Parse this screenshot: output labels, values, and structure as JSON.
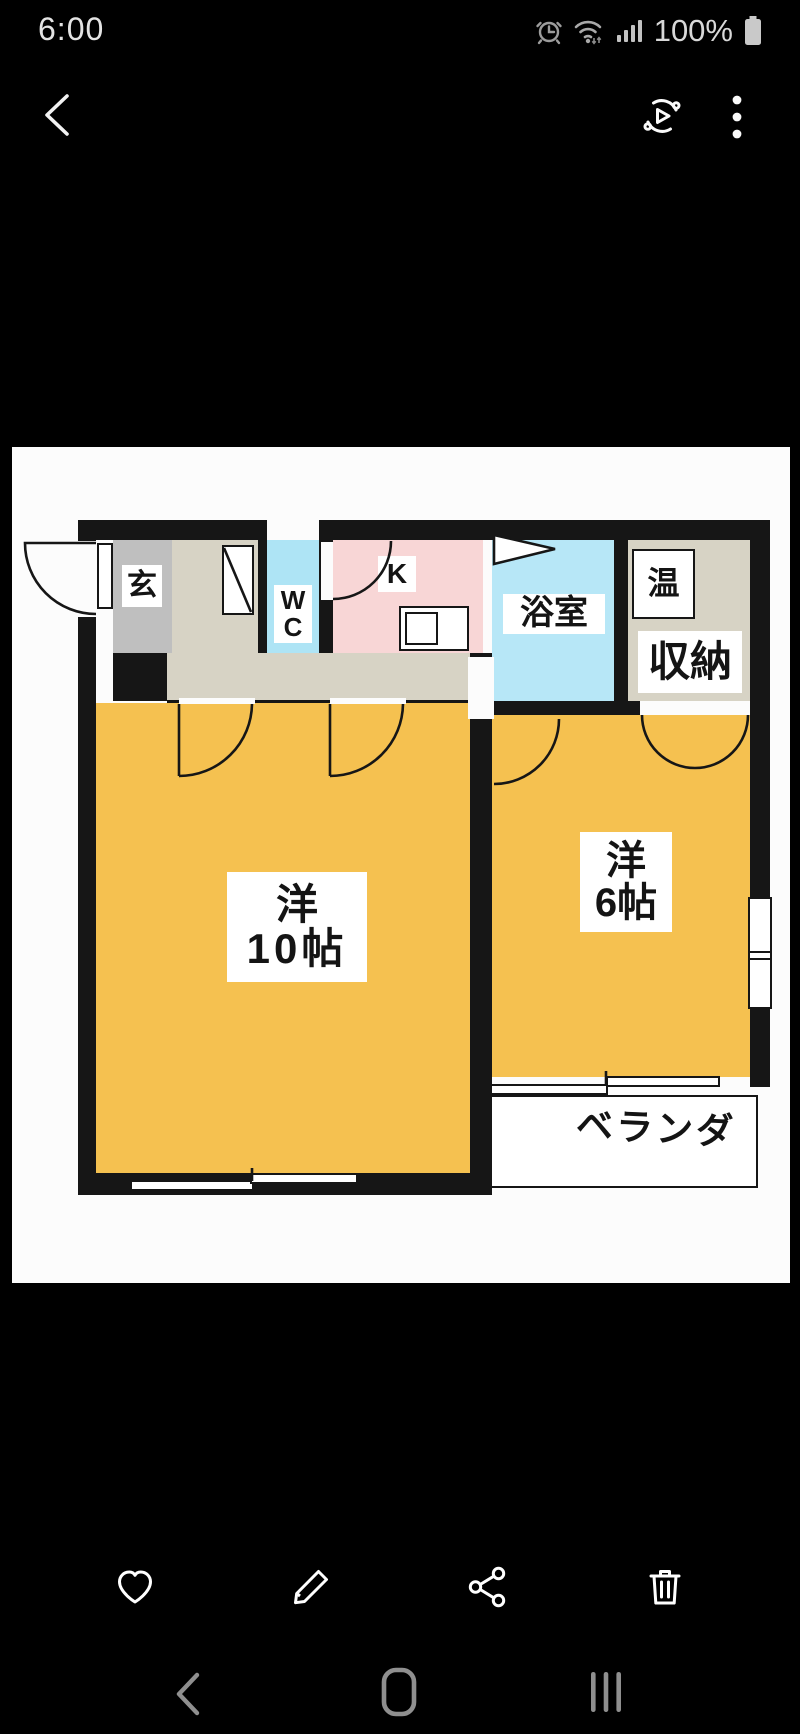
{
  "status_bar": {
    "time": "6:00",
    "battery_level": "100%",
    "icons": [
      "alarm-icon",
      "wifi-icon",
      "cellular-signal-icon",
      "battery-icon"
    ]
  },
  "app_bar": {
    "icons": [
      "back-icon",
      "motion-photo-icon",
      "more-options-icon"
    ]
  },
  "photo_viewer": {
    "content": "apartment floor plan photo",
    "floor_plan": {
      "rooms": {
        "genkan": {
          "label": "玄",
          "color": "#bfbfbf"
        },
        "wc": {
          "label_line1": "W",
          "label_line2": "C",
          "color": "#aee4f5"
        },
        "kitchen": {
          "label": "K",
          "color": "#f8d6d6"
        },
        "bathroom": {
          "label": "浴室",
          "color": "#b7e7f7"
        },
        "water_heater": {
          "label": "温",
          "color": "#ffffff"
        },
        "storage": {
          "label": "収納",
          "color": "#d7d3c5"
        },
        "western_room_10": {
          "label_line1": "洋",
          "label_line2": "10帖",
          "color": "#f5c150"
        },
        "western_room_6": {
          "label_line1": "洋",
          "label_line2": "6帖",
          "color": "#f5c150"
        },
        "veranda": {
          "label": "ベランダ",
          "color": "#ffffff"
        }
      },
      "wall_color": "#161616",
      "hall_color": "#d7d3c5",
      "background": "#fcfcfc"
    }
  },
  "action_bar": {
    "buttons": [
      {
        "name": "favorite",
        "icon": "heart-icon"
      },
      {
        "name": "edit",
        "icon": "pencil-icon"
      },
      {
        "name": "share",
        "icon": "share-icon"
      },
      {
        "name": "delete",
        "icon": "trash-icon"
      }
    ]
  },
  "nav_bar": {
    "icons": [
      "back-icon",
      "home-icon",
      "recents-icon"
    ]
  }
}
